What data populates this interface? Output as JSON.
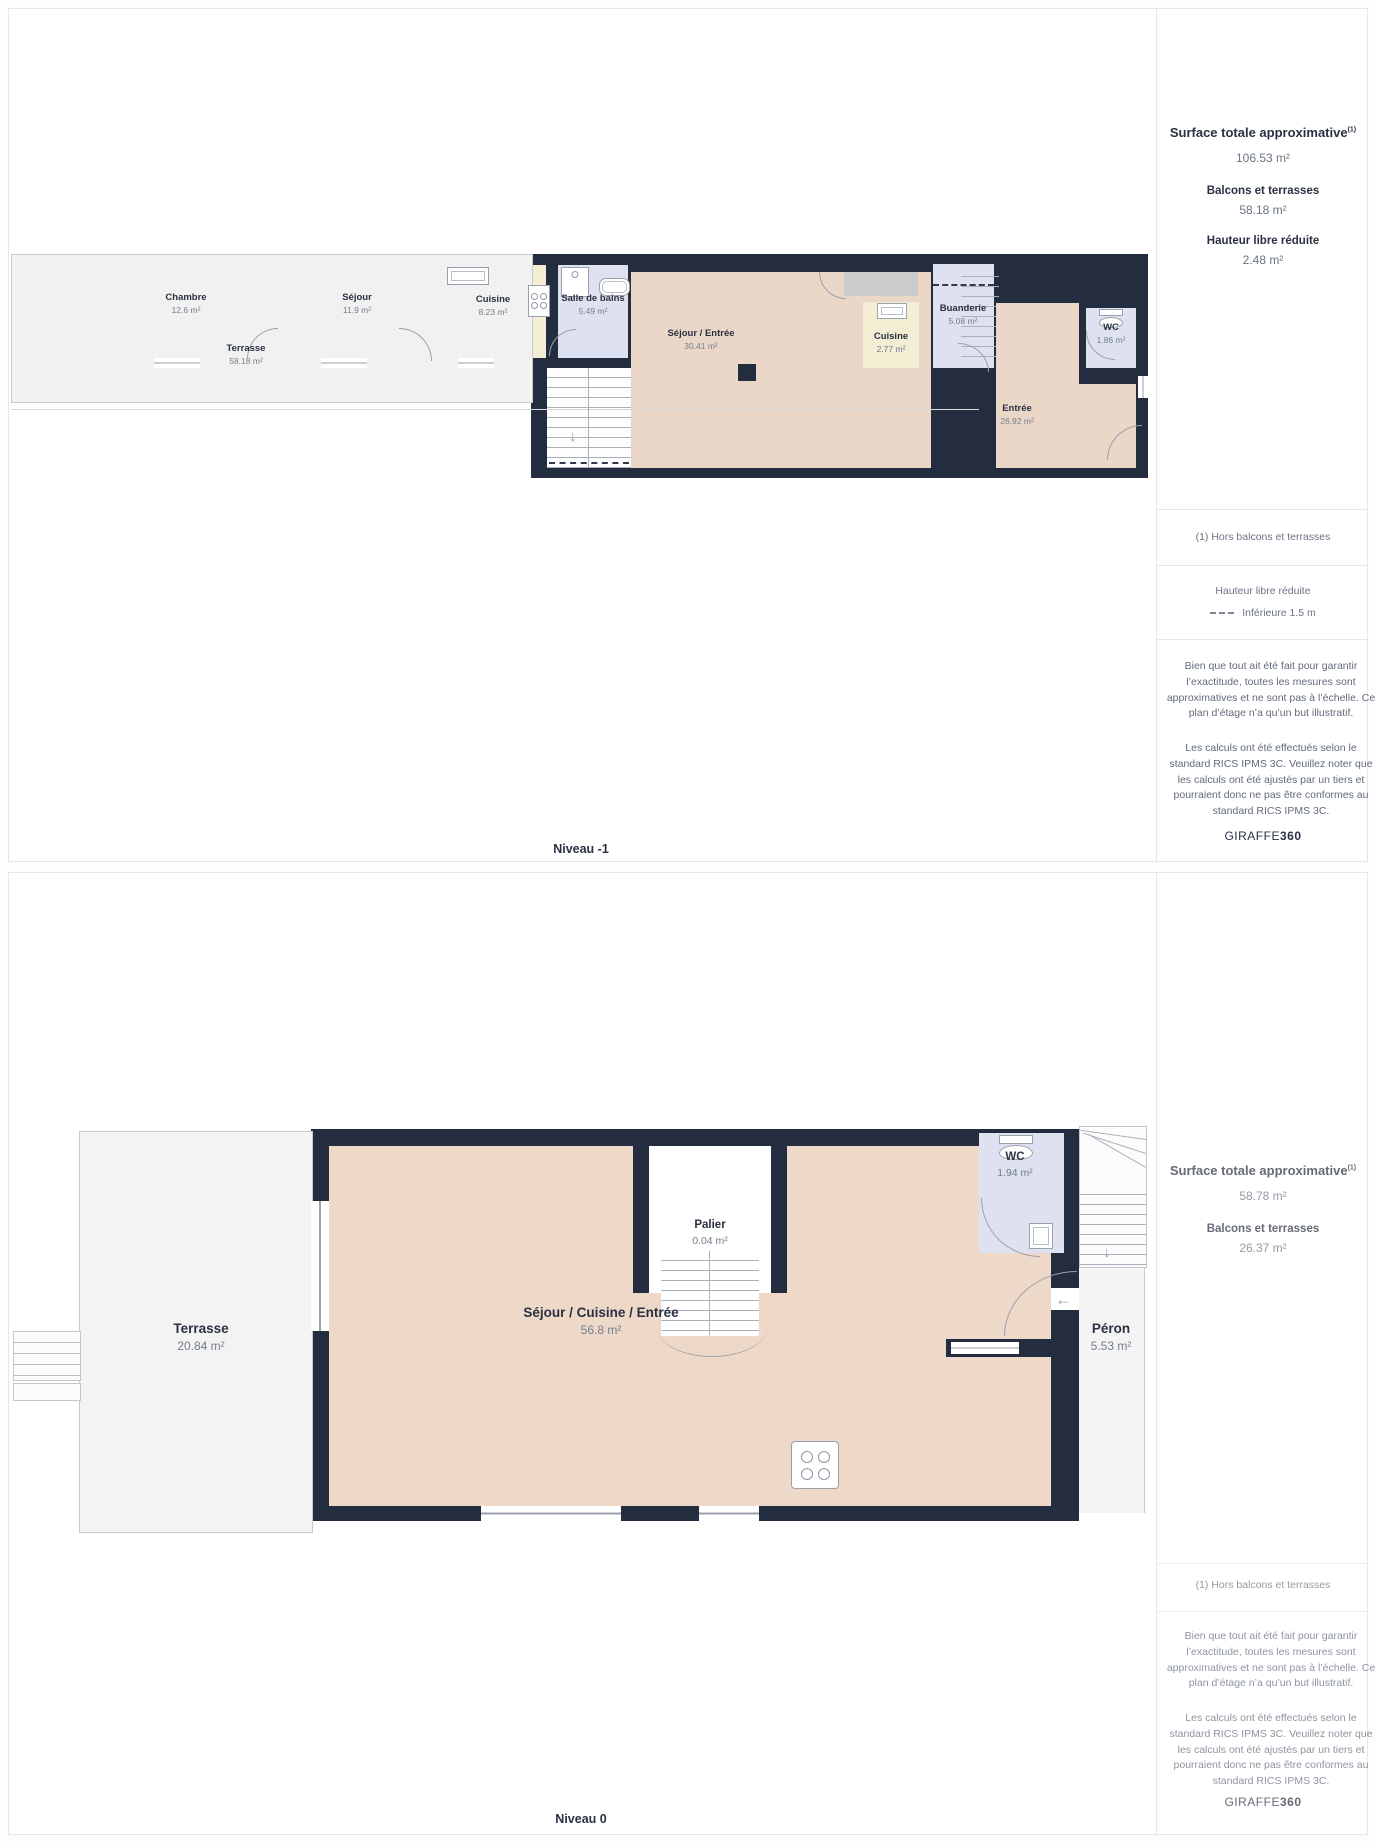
{
  "panels": [
    {
      "level_label": "Niveau -1",
      "sidebar": {
        "title": "Surface totale approximative",
        "title_sup": "(1)",
        "total_value": "106.53 m²",
        "balconies_heading": "Balcons et terrasses",
        "balconies_value": "58.18 m²",
        "reduced_height_heading": "Hauteur libre réduite",
        "reduced_height_value": "2.48 m²",
        "footnote": "(1) Hors balcons et terrasses",
        "legend_heading": "Hauteur libre réduite",
        "legend_label": "Inférieure 1.5 m",
        "disclaimer_measures": "Bien que tout ait été fait pour garantir l’exactitude, toutes les mesures sont approximatives et ne sont pas à l’échelle. Ce plan d’étage n’a qu’un but illustratif.",
        "disclaimer_standard": "Les calculs ont été effectués selon le standard RICS IPMS 3C. Veuillez noter que les calculs ont été ajustés par un tiers et pourraient donc ne pas être conformes au standard RICS IPMS 3C.",
        "brand_name": "GIRAFFE",
        "brand_suffix": "360"
      },
      "rooms": {
        "chambre": {
          "name": "Chambre",
          "area": "12.6 m²"
        },
        "sejour": {
          "name": "Séjour",
          "area": "11.9 m²"
        },
        "cuisine": {
          "name": "Cuisine",
          "area": "8.23 m²"
        },
        "salle_de_bains": {
          "name": "Salle de bains",
          "area": "5.49 m²"
        },
        "sejour_entree": {
          "name": "Séjour / Entrée",
          "area": "30.41 m²"
        },
        "cuisine2": {
          "name": "Cuisine",
          "area": "2.77 m²"
        },
        "buanderie": {
          "name": "Buanderie",
          "area": "5.08 m²"
        },
        "wc": {
          "name": "WC",
          "area": "1.86 m²"
        },
        "entree": {
          "name": "Entrée",
          "area": "26.92 m²"
        },
        "terrasse": {
          "name": "Terrasse",
          "area": "58.18 m²"
        }
      }
    },
    {
      "level_label": "Niveau 0",
      "sidebar": {
        "title": "Surface totale approximative",
        "title_sup": "(1)",
        "total_value": "58.78 m²",
        "balconies_heading": "Balcons et terrasses",
        "balconies_value": "26.37 m²",
        "footnote": "(1) Hors balcons et terrasses",
        "disclaimer_measures": "Bien que tout ait été fait pour garantir l’exactitude, toutes les mesures sont approximatives et ne sont pas à l’échelle. Ce plan d’étage n’a qu’un but illustratif.",
        "disclaimer_standard": "Les calculs ont été effectués selon le standard RICS IPMS 3C. Veuillez noter que les calculs ont été ajustés par un tiers et pourraient donc ne pas être conformes au standard RICS IPMS 3C.",
        "brand_name": "GIRAFFE",
        "brand_suffix": "360"
      },
      "rooms": {
        "terrasse": {
          "name": "Terrasse",
          "area": "20.84 m²"
        },
        "palier": {
          "name": "Palier",
          "area": "0.04 m²"
        },
        "wc": {
          "name": "WC",
          "area": "1.94 m²"
        },
        "sejour_cuisine_entree": {
          "name": "Séjour / Cuisine / Entrée",
          "area": "56.8 m²"
        },
        "peron": {
          "name": "Péron",
          "area": "5.53 m²"
        }
      }
    }
  ],
  "icons": [
    "sink-icon",
    "stove-icon",
    "shower-icon",
    "bathtub-icon",
    "toilet-icon",
    "stairs-icon",
    "door-arc-icon",
    "window-icon",
    "arrow-down-icon",
    "arrow-left-icon"
  ],
  "colors": {
    "wall": "#242d3f",
    "room_tan": "#ebd7c8",
    "room_cream": "#fbf2e1",
    "room_yellow": "#f2edd3",
    "room_blue": "#dee2f0",
    "terrace_gray": "#f1f1f2",
    "low_height_gray": "#cacbcd",
    "accent_text": "#2a3142",
    "muted_text": "#6b7482"
  }
}
